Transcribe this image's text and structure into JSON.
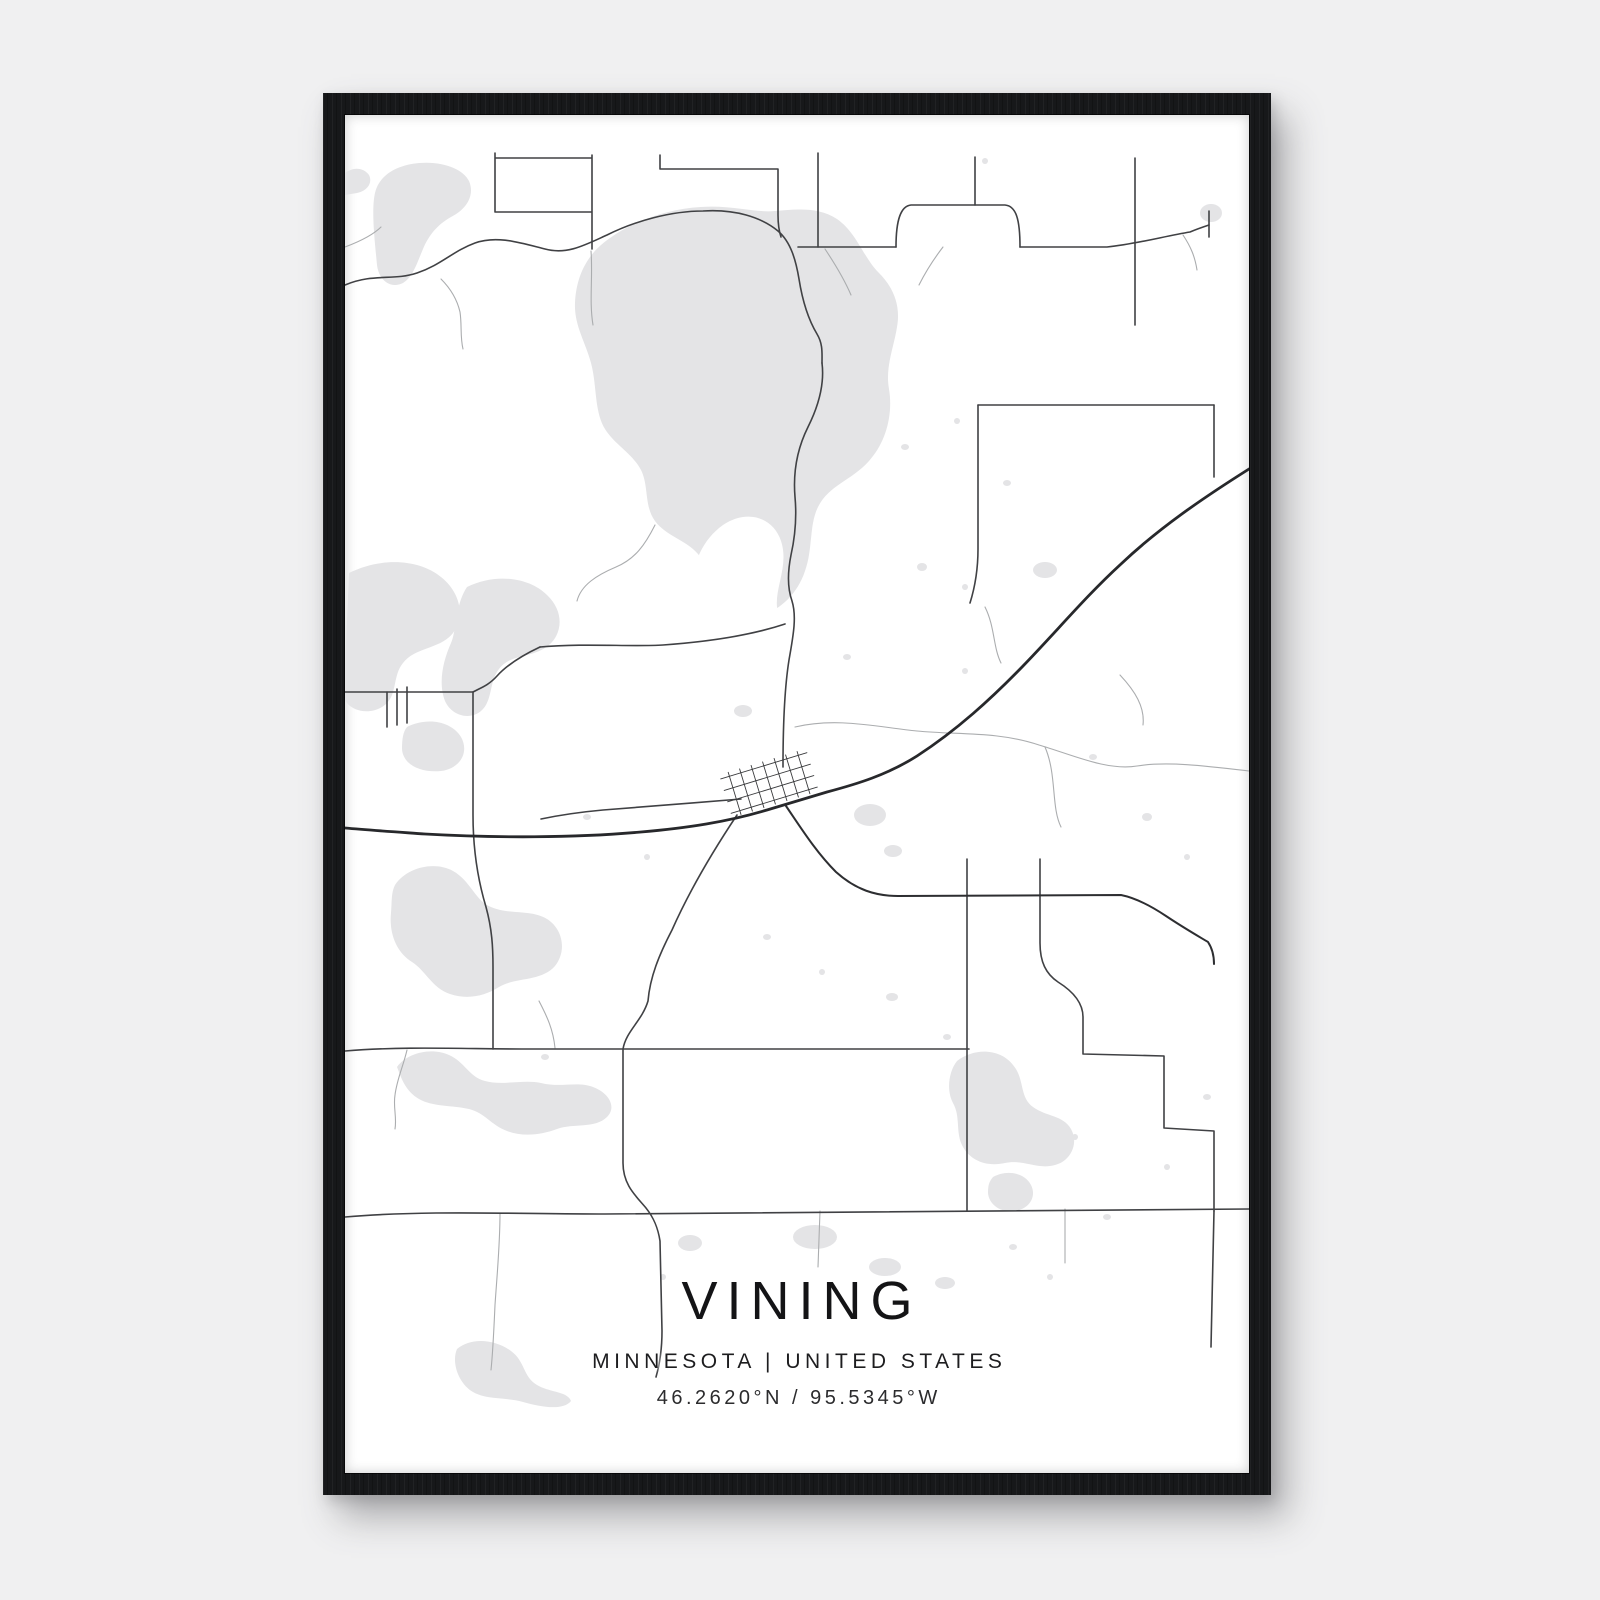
{
  "poster": {
    "title": "VINING",
    "subtitle": "MINNESOTA | UNITED STATES",
    "coordinates": "46.2620°N / 95.5345°W"
  },
  "colors": {
    "page_background": "#f0f0f1",
    "frame": "#17181a",
    "paper": "#ffffff",
    "water": "#e4e4e6",
    "road_major": "#404144",
    "road_minor": "#abadaf",
    "highway": "#27282b",
    "text": "#141416"
  }
}
